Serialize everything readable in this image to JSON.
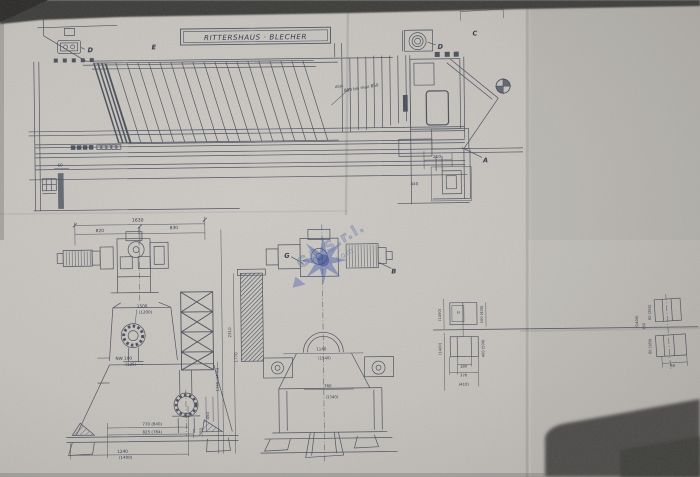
{
  "drawing": {
    "title_box": "RITTERSHAUS · BLECHER",
    "note_prefix": "Abst.",
    "note_distance": "800 bis max 850",
    "labels": {
      "d_left": "D",
      "e_top": "E",
      "d_right": "D",
      "c_top": "C",
      "a_right": "A",
      "g_mid": "G",
      "b_mid": "B"
    },
    "dims_top": {
      "d693": "693",
      "d60": "60",
      "d210": "210",
      "d440": "440"
    },
    "dims_left": {
      "overall": "1630",
      "left": "820",
      "right": "830",
      "height": "1500",
      "height_alt": "(1200)",
      "nozzle": "NW 100",
      "nozzle_alt": "(125)",
      "base_a": "770 (840)",
      "base_b": "825 (784)",
      "base_c": "1240",
      "base_c_alt": "(1400)",
      "v_a": "450",
      "v_b": "300"
    },
    "dims_mid": {
      "width_a": "1140",
      "width_a_alt": "(1540)",
      "width_b": "760",
      "width_b_alt": "(1340)",
      "height_a": "2310",
      "height_b": "1770",
      "height_c": "1150 (1470)"
    },
    "sections": {
      "s1_left": "(1400)",
      "s1_right": "100 (400)",
      "s1_mark": "H",
      "s2_left": "(1400)",
      "s2_right": "400 (500)",
      "s2_b1": "180",
      "s2_b2": "370",
      "s2_b3": "(410)",
      "f1_a": "60 (260)",
      "f1_b": "150",
      "f1_c": "(1400)",
      "f2_a": "60 (180)",
      "f2_b": "90"
    }
  },
  "watermark": {
    "line1": "GA S.r.l.",
    "line2": "cer.com"
  },
  "colors": {
    "ink": "#3a4150",
    "paper": "#c6c3be",
    "watermark_blue": "#4056b0",
    "shadow": "#4e4c49"
  }
}
